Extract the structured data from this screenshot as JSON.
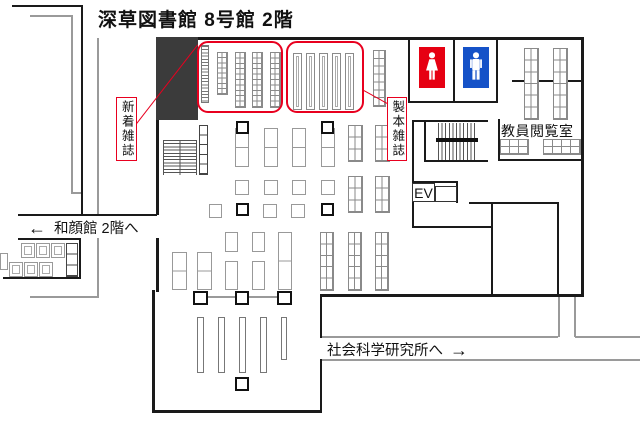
{
  "title": "深草図書館 8号館 2階",
  "signs": {
    "new_magazines": "新着雑誌",
    "bound_magazines": "製本雑誌",
    "faculty_room": "教員閲覧室",
    "elevator": "EV",
    "wagankan": {
      "arrow": "←",
      "text": "和顔館 2階へ"
    },
    "social_science": {
      "text": "社会科学研究所へ",
      "arrow": "→"
    }
  },
  "icons": {
    "female_restroom": "female-icon",
    "male_restroom": "male-icon"
  },
  "colors": {
    "wall": "#1a1a1a",
    "gray_line": "#9a9a9a",
    "shelf_line": "#8a8a8a",
    "highlight": "#e8001f",
    "dark_block": "#3b3b3b",
    "female": "#e60012",
    "male": "#1552c8"
  },
  "floorplan": {
    "canvas": {
      "w": 640,
      "h": 428
    },
    "dark_block": {
      "x": 156,
      "y": 37,
      "w": 42,
      "h": 83
    },
    "walls": [
      {
        "x": 12,
        "y": 5,
        "w": 71,
        "h": 2
      },
      {
        "x": 81,
        "y": 5,
        "w": 2,
        "h": 211
      },
      {
        "x": 18,
        "y": 214,
        "w": 139,
        "h": 2
      },
      {
        "x": 18,
        "y": 238,
        "w": 63,
        "h": 2
      },
      {
        "x": 79,
        "y": 238,
        "w": 2,
        "h": 41
      },
      {
        "x": 3,
        "y": 277,
        "w": 78,
        "h": 2
      },
      {
        "x": 156,
        "y": 37,
        "w": 428,
        "h": 3
      },
      {
        "x": 581,
        "y": 37,
        "w": 3,
        "h": 260
      },
      {
        "x": 322,
        "y": 294,
        "w": 262,
        "h": 3
      },
      {
        "x": 156,
        "y": 40,
        "w": 3,
        "h": 175
      },
      {
        "x": 156,
        "y": 238,
        "w": 3,
        "h": 54
      },
      {
        "x": 152,
        "y": 290,
        "w": 3,
        "h": 122
      },
      {
        "x": 152,
        "y": 410,
        "w": 170,
        "h": 3
      },
      {
        "x": 320,
        "y": 294,
        "w": 2,
        "h": 44
      },
      {
        "x": 320,
        "y": 359,
        "w": 2,
        "h": 53
      },
      {
        "x": 408,
        "y": 37,
        "w": 2,
        "h": 66
      },
      {
        "x": 453,
        "y": 37,
        "w": 2,
        "h": 66
      },
      {
        "x": 496,
        "y": 37,
        "w": 2,
        "h": 66
      },
      {
        "x": 408,
        "y": 101,
        "w": 90,
        "h": 2
      },
      {
        "x": 498,
        "y": 119,
        "w": 2,
        "h": 42
      },
      {
        "x": 498,
        "y": 159,
        "w": 86,
        "h": 2
      },
      {
        "x": 512,
        "y": 80,
        "w": 70,
        "h": 1.5
      },
      {
        "x": 412,
        "y": 120,
        "w": 76,
        "h": 2
      },
      {
        "x": 412,
        "y": 120,
        "w": 2,
        "h": 108
      },
      {
        "x": 424,
        "y": 121,
        "w": 1.5,
        "h": 40
      },
      {
        "x": 424,
        "y": 160,
        "w": 64,
        "h": 1.5
      },
      {
        "x": 412,
        "y": 181,
        "w": 45,
        "h": 1.5
      },
      {
        "x": 456,
        "y": 181,
        "w": 1.5,
        "h": 22
      },
      {
        "x": 469,
        "y": 202,
        "w": 90,
        "h": 2
      },
      {
        "x": 491,
        "y": 203,
        "w": 1.5,
        "h": 92
      },
      {
        "x": 557,
        "y": 203,
        "w": 2,
        "h": 92
      },
      {
        "x": 412,
        "y": 226,
        "w": 80,
        "h": 1.5
      }
    ],
    "gray_walls": [
      {
        "x": 30,
        "y": 15,
        "w": 42,
        "h": 1.5
      },
      {
        "x": 71,
        "y": 15,
        "w": 1.5,
        "h": 179
      },
      {
        "x": 71,
        "y": 192,
        "w": 11,
        "h": 1.5
      },
      {
        "x": 97,
        "y": 38,
        "w": 1.5,
        "h": 178
      },
      {
        "x": 97,
        "y": 238,
        "w": 1.5,
        "h": 60
      },
      {
        "x": 30,
        "y": 296,
        "w": 68,
        "h": 1.5
      },
      {
        "x": 322,
        "y": 336,
        "w": 236,
        "h": 2
      },
      {
        "x": 575,
        "y": 336,
        "w": 65,
        "h": 2
      },
      {
        "x": 558,
        "y": 297,
        "w": 2,
        "h": 40
      },
      {
        "x": 574,
        "y": 297,
        "w": 2,
        "h": 40
      },
      {
        "x": 322,
        "y": 359,
        "w": 318,
        "h": 2
      },
      {
        "x": 200,
        "y": 296,
        "w": 85,
        "h": 1.5
      }
    ],
    "ev_boxes": [
      {
        "x": 412,
        "y": 183,
        "w": 23,
        "h": 19
      },
      {
        "x": 435,
        "y": 186,
        "w": 22,
        "h": 16
      }
    ],
    "staircases": [
      {
        "t": "h",
        "x": 163,
        "y": 140,
        "w": 34,
        "h": 35
      },
      {
        "t": "v",
        "x": 438,
        "y": 123,
        "w": 38,
        "h": 37
      }
    ],
    "stair_bar": {
      "x": 436,
      "y": 138,
      "w": 42,
      "h": 4
    },
    "highlight_boxes": [
      {
        "x": 197,
        "y": 41,
        "w": 86,
        "h": 72
      },
      {
        "x": 286,
        "y": 41,
        "w": 78,
        "h": 72
      }
    ],
    "leader_lines": [
      {
        "x": 136,
        "y": 124,
        "len": 101,
        "angle": -52.2
      },
      {
        "x": 362,
        "y": 89,
        "len": 31,
        "angle": 29.1
      }
    ],
    "toilets": {
      "female": {
        "x": 419,
        "y": 47,
        "w": 26,
        "h": 41
      },
      "male": {
        "x": 463,
        "y": 47,
        "w": 26,
        "h": 41
      }
    },
    "pillars": [
      {
        "x": 236,
        "y": 121,
        "w": 13,
        "h": 13
      },
      {
        "x": 321,
        "y": 121,
        "w": 13,
        "h": 13
      },
      {
        "x": 236,
        "y": 203,
        "w": 13,
        "h": 13
      },
      {
        "x": 321,
        "y": 203,
        "w": 13,
        "h": 13
      },
      {
        "x": 193,
        "y": 291,
        "w": 15,
        "h": 14
      },
      {
        "x": 235,
        "y": 291,
        "w": 14,
        "h": 14
      },
      {
        "x": 277,
        "y": 291,
        "w": 15,
        "h": 14
      },
      {
        "x": 235,
        "y": 377,
        "w": 14,
        "h": 14
      }
    ],
    "shelves": [
      {
        "t": "rungs",
        "x": 201,
        "y": 45,
        "w": 8,
        "h": 58
      },
      {
        "t": "grid",
        "x": 217,
        "y": 52,
        "w": 11,
        "h": 43,
        "c": 2,
        "r": 8
      },
      {
        "t": "grid",
        "x": 235,
        "y": 52,
        "w": 11,
        "h": 56,
        "c": 2,
        "r": 10
      },
      {
        "t": "grid",
        "x": 252,
        "y": 52,
        "w": 11,
        "h": 56,
        "c": 2,
        "r": 10
      },
      {
        "t": "grid",
        "x": 270,
        "y": 52,
        "w": 11,
        "h": 56,
        "c": 2,
        "r": 10
      },
      {
        "t": "double",
        "x": 293,
        "y": 53,
        "w": 9,
        "h": 57
      },
      {
        "t": "double",
        "x": 306,
        "y": 53,
        "w": 9,
        "h": 57
      },
      {
        "t": "double",
        "x": 319,
        "y": 53,
        "w": 9,
        "h": 57
      },
      {
        "t": "double",
        "x": 332,
        "y": 53,
        "w": 9,
        "h": 57
      },
      {
        "t": "double",
        "x": 345,
        "y": 53,
        "w": 9,
        "h": 57
      },
      {
        "t": "grid",
        "x": 373,
        "y": 50,
        "w": 13,
        "h": 57,
        "c": 2,
        "r": 7
      },
      {
        "t": "grid",
        "x": 524,
        "y": 48,
        "w": 15,
        "h": 72,
        "c": 2,
        "r": 6
      },
      {
        "t": "grid",
        "x": 553,
        "y": 48,
        "w": 15,
        "h": 72,
        "c": 2,
        "r": 6
      },
      {
        "t": "grid",
        "x": 500,
        "y": 139,
        "w": 29,
        "h": 16,
        "c": 3,
        "r": 2
      },
      {
        "t": "grid",
        "x": 543,
        "y": 139,
        "w": 38,
        "h": 16,
        "c": 4,
        "r": 2
      },
      {
        "t": "cells",
        "x": 199,
        "y": 125,
        "w": 9,
        "h": 50,
        "r": 5
      },
      {
        "t": "split",
        "x": 235,
        "y": 128,
        "w": 14,
        "h": 39
      },
      {
        "t": "split",
        "x": 264,
        "y": 128,
        "w": 14,
        "h": 39
      },
      {
        "t": "split",
        "x": 292,
        "y": 128,
        "w": 14,
        "h": 39
      },
      {
        "t": "split",
        "x": 321,
        "y": 128,
        "w": 14,
        "h": 39
      },
      {
        "t": "plain",
        "x": 235,
        "y": 180,
        "w": 14,
        "h": 15
      },
      {
        "t": "plain",
        "x": 264,
        "y": 180,
        "w": 14,
        "h": 15
      },
      {
        "t": "plain",
        "x": 292,
        "y": 180,
        "w": 14,
        "h": 15
      },
      {
        "t": "plain",
        "x": 321,
        "y": 180,
        "w": 14,
        "h": 15
      },
      {
        "t": "plain",
        "x": 209,
        "y": 204,
        "w": 13,
        "h": 14
      },
      {
        "t": "plain",
        "x": 263,
        "y": 204,
        "w": 14,
        "h": 14
      },
      {
        "t": "plain",
        "x": 291,
        "y": 204,
        "w": 14,
        "h": 14
      },
      {
        "t": "grid",
        "x": 348,
        "y": 125,
        "w": 15,
        "h": 37,
        "c": 2,
        "r": 3
      },
      {
        "t": "grid",
        "x": 375,
        "y": 125,
        "w": 15,
        "h": 37,
        "c": 2,
        "r": 3
      },
      {
        "t": "grid",
        "x": 348,
        "y": 176,
        "w": 15,
        "h": 37,
        "c": 2,
        "r": 3
      },
      {
        "t": "grid",
        "x": 375,
        "y": 176,
        "w": 15,
        "h": 37,
        "c": 2,
        "r": 3
      },
      {
        "t": "grid",
        "x": 320,
        "y": 232,
        "w": 14,
        "h": 59,
        "c": 2,
        "r": 5
      },
      {
        "t": "grid",
        "x": 348,
        "y": 232,
        "w": 14,
        "h": 59,
        "c": 2,
        "r": 5
      },
      {
        "t": "grid",
        "x": 375,
        "y": 232,
        "w": 14,
        "h": 59,
        "c": 2,
        "r": 5
      },
      {
        "t": "split",
        "x": 172,
        "y": 252,
        "w": 15,
        "h": 38
      },
      {
        "t": "split",
        "x": 197,
        "y": 252,
        "w": 15,
        "h": 38
      },
      {
        "t": "plain",
        "x": 225,
        "y": 232,
        "w": 13,
        "h": 20
      },
      {
        "t": "plain",
        "x": 225,
        "y": 261,
        "w": 13,
        "h": 29
      },
      {
        "t": "plain",
        "x": 252,
        "y": 232,
        "w": 13,
        "h": 20
      },
      {
        "t": "plain",
        "x": 252,
        "y": 261,
        "w": 13,
        "h": 29
      },
      {
        "t": "split",
        "x": 278,
        "y": 232,
        "w": 14,
        "h": 58
      },
      {
        "t": "bar",
        "x": 197,
        "y": 317,
        "w": 7,
        "h": 56
      },
      {
        "t": "bar",
        "x": 218,
        "y": 317,
        "w": 7,
        "h": 56
      },
      {
        "t": "bar",
        "x": 239,
        "y": 317,
        "w": 7,
        "h": 56
      },
      {
        "t": "bar",
        "x": 260,
        "y": 317,
        "w": 7,
        "h": 56
      },
      {
        "t": "bar",
        "x": 281,
        "y": 317,
        "w": 6,
        "h": 43
      },
      {
        "t": "table",
        "x": 21,
        "y": 243,
        "w": 14,
        "h": 15
      },
      {
        "t": "table",
        "x": 36,
        "y": 243,
        "w": 14,
        "h": 15
      },
      {
        "t": "table",
        "x": 51,
        "y": 243,
        "w": 14,
        "h": 15
      },
      {
        "t": "table",
        "x": 9,
        "y": 262,
        "w": 14,
        "h": 15
      },
      {
        "t": "table",
        "x": 24,
        "y": 262,
        "w": 14,
        "h": 15
      },
      {
        "t": "table",
        "x": 39,
        "y": 262,
        "w": 14,
        "h": 15
      },
      {
        "t": "plain",
        "x": 0,
        "y": 253,
        "w": 8,
        "h": 17
      },
      {
        "t": "cells",
        "x": 66,
        "y": 243,
        "w": 12,
        "h": 34,
        "r": 3
      }
    ],
    "label_positions": {
      "title": {
        "x": 98,
        "y": 5
      },
      "new_magazines": {
        "x": 116,
        "y": 97,
        "w": 21,
        "h": 64
      },
      "bound_magazines": {
        "x": 387,
        "y": 97,
        "w": 20,
        "h": 64
      },
      "faculty_room": {
        "x": 501,
        "y": 121
      },
      "elevator": {
        "x": 412,
        "y": 183
      },
      "wagankan": {
        "x": 28,
        "y": 217
      },
      "social_science": {
        "x": 327,
        "y": 339
      }
    }
  }
}
